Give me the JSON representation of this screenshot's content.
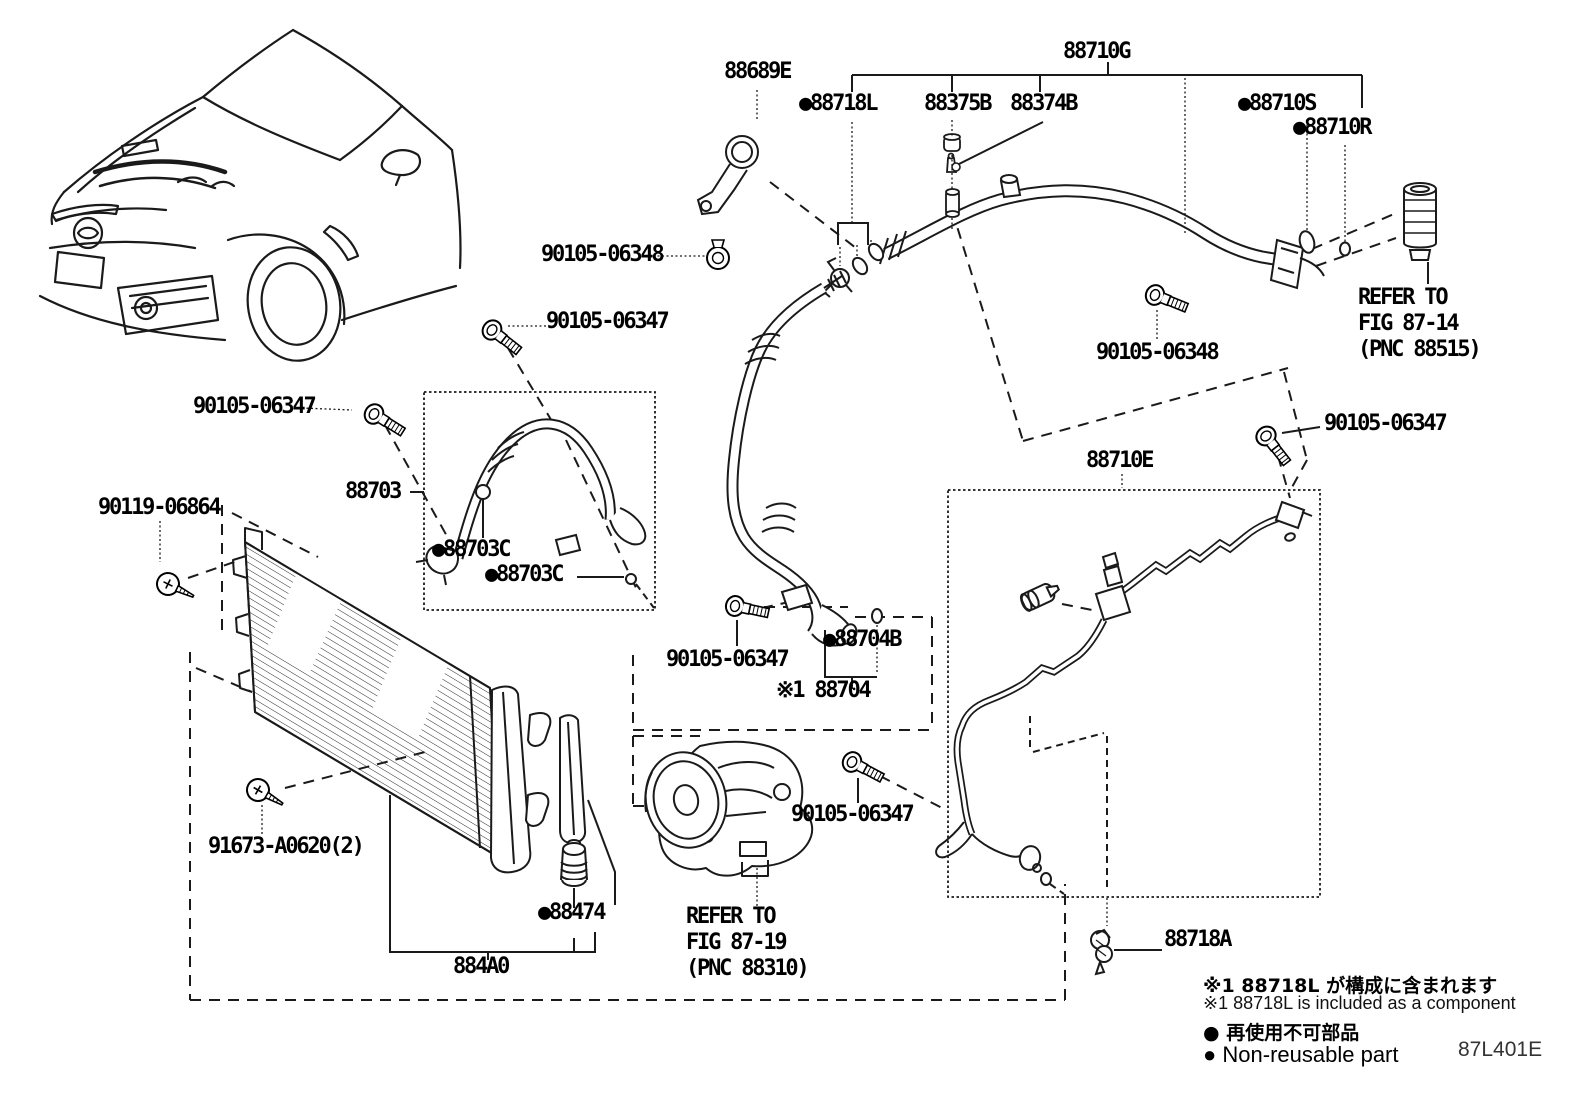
{
  "figure_code": "87L401E",
  "labels": {
    "p88689e": "88689E",
    "p88710g": "88710G",
    "p88718l": "●88718L",
    "p88375b": "88375B",
    "p88374b": "88374B",
    "p88710s": "●88710S",
    "p88710r": "●88710R",
    "p90105_06348_a": "90105-06348",
    "p90105_06348_b": "90105-06348",
    "p90105_06347_a": "90105-06347",
    "p90105_06347_b": "90105-06347",
    "p90105_06347_c": "90105-06347",
    "p90105_06347_d": "90105-06347",
    "p90105_06347_e": "90105-06347",
    "p88703": "88703",
    "p88703c_1": "●88703C",
    "p88703c_2": "●88703C",
    "p90119_06864": "90119-06864",
    "p88710e": "88710E",
    "p88704b": "●88704B",
    "p88704": "※1 88704",
    "p91673_a0620": "91673-A0620(2)",
    "p88474": "●88474",
    "p884a0": "884A0",
    "p88718a": "88718A"
  },
  "refer_notes": {
    "fig_87_14": "REFER TO\nFIG 87-14\n(PNC 88515)",
    "fig_87_19": "REFER TO\nFIG 87-19\n(PNC 88310)"
  },
  "footnotes": {
    "jp_component": "※1 88718L が構成に含まれます",
    "en_component": "※1 88718L is included as a component",
    "jp_nonreusable": "● 再使用不可部品",
    "en_nonreusable": "● Non-reusable part"
  },
  "colors": {
    "line": "#1a1a1a",
    "background": "#ffffff"
  }
}
